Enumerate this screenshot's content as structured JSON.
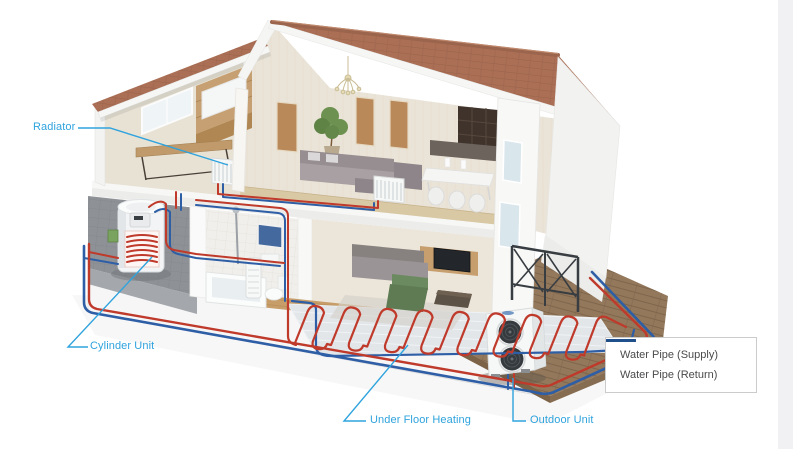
{
  "labels": {
    "radiator": "Radiator",
    "cylinder_unit": "Cylinder Unit",
    "under_floor_heating": "Under Floor Heating",
    "outdoor_unit": "Outdoor Unit"
  },
  "legend": {
    "items": [
      {
        "label": "Water Pipe (Supply)",
        "color": "#d8232a"
      },
      {
        "label": "Water Pipe (Return)",
        "color": "#20508c"
      }
    ]
  },
  "colors": {
    "accent": "#2fa3dd",
    "pipe_supply": "#bf3a2b",
    "pipe_return": "#2e5ea6",
    "roof": "#aa6f55",
    "text": "#4a4a4c",
    "deck_wood": "#93785c",
    "wall_cream": "#eae4d8",
    "tile_gray": "#8e9297"
  }
}
